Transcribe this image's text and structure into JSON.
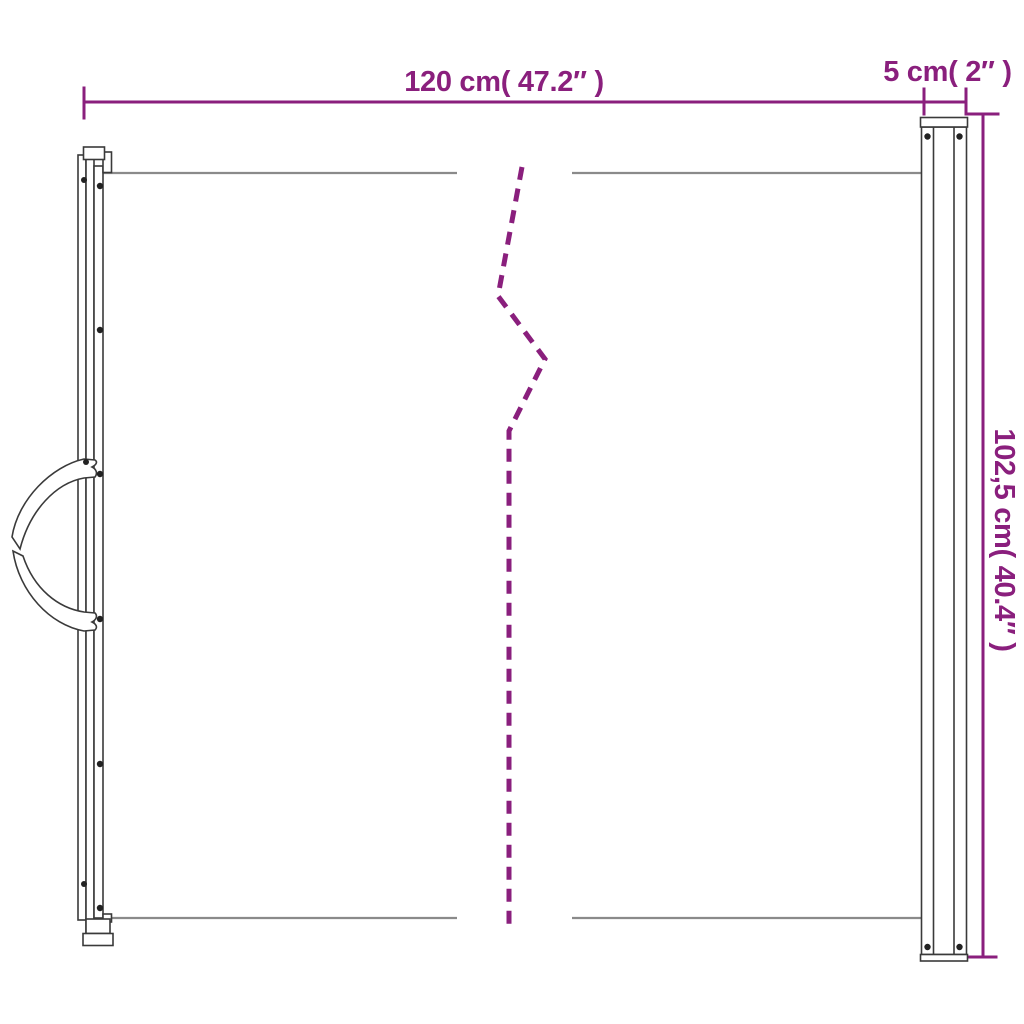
{
  "diagram": {
    "type": "product-dimension-drawing",
    "product": "retractable-gate-side-view",
    "dimensions": {
      "width_label": "120 cm( 47.2″ )",
      "cassette_width_label": "5 cm( 2″ )",
      "height_label": "102,5 cm( 40.4″ )"
    },
    "colors": {
      "dimension": "#8A1F7D",
      "outline": "#3A3A3A",
      "mesh_line": "#8A8A8A",
      "background": "#FFFFFF"
    }
  }
}
